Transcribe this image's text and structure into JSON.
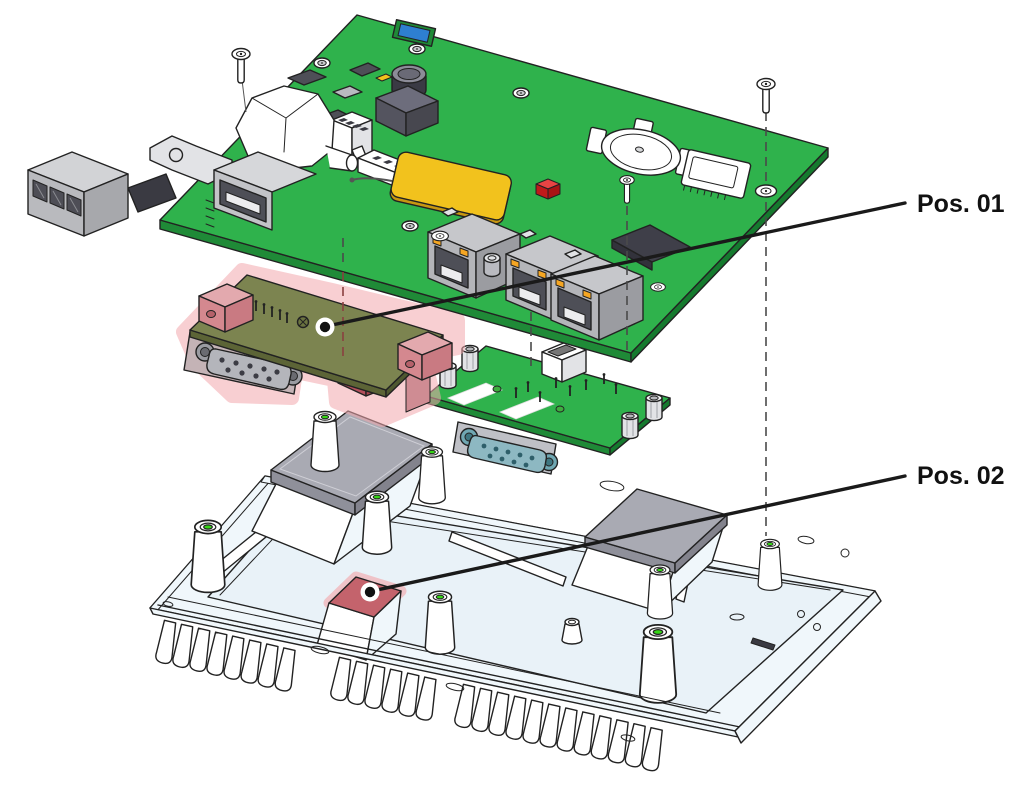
{
  "diagram": {
    "type": "exploded-assembly-technical-illustration",
    "background": "#ffffff",
    "callouts": [
      {
        "label": "Pos. 01",
        "target_part": "serial-interface-module"
      },
      {
        "label": "Pos. 02",
        "target_part": "thermal-pad-block"
      }
    ],
    "parts": [
      {
        "name": "mainboard-pcb"
      },
      {
        "name": "mounting-screw-left"
      },
      {
        "name": "mounting-screw-center"
      },
      {
        "name": "mounting-screw-right"
      },
      {
        "name": "serial-interface-module",
        "highlighted": true,
        "callout": "Pos. 01"
      },
      {
        "name": "io-adapter-board"
      },
      {
        "name": "heatsink-chassis"
      },
      {
        "name": "thermal-pad-left"
      },
      {
        "name": "thermal-pad-right"
      },
      {
        "name": "thermal-pad-block",
        "highlighted": true,
        "callout": "Pos. 02"
      },
      {
        "name": "db9-serial-connector-module"
      },
      {
        "name": "db9-serial-connector-adapter"
      },
      {
        "name": "ethernet-port-1"
      },
      {
        "name": "ethernet-port-2"
      },
      {
        "name": "ethernet-port-3"
      },
      {
        "name": "usb-port"
      },
      {
        "name": "terminal-block-connector"
      },
      {
        "name": "coin-cell-battery-holder"
      },
      {
        "name": "microsd-card-slot"
      },
      {
        "name": "antenna-pad"
      },
      {
        "name": "buzzer"
      },
      {
        "name": "standoff-posts"
      },
      {
        "name": "cooling-fins"
      }
    ],
    "colors": {
      "white": "#ffffff",
      "pcb_green": "#2fb24c",
      "pcb_green_dark": "#1f8a37",
      "module_olive": "#7c8450",
      "module_olive_edge": "#5c6436",
      "highlight_pink": "#f3a9ae",
      "highlight_red": "#c4636c",
      "chassis_fill": "#f0f7fb",
      "chassis_floor": "#e9f2f8",
      "pad_gray": "#a9aab3",
      "pad_gray_side": "#8f909a",
      "connector_gray": "#c6c7cb",
      "connector_gray_dark": "#9b9ca1",
      "connector_dark": "#4e4f57",
      "metal_light": "#e2e3e6",
      "teal": "#8db8c2",
      "yellow": "#f2c21d",
      "blue": "#2e7fd0",
      "red": "#e02222",
      "orange": "#f5a623",
      "thread_green": "#35d615",
      "line": "#222222",
      "dash": "#4a4a4a",
      "dash_red": "#8a4040",
      "leader": "#1a1a1a",
      "label_text": "#111111"
    }
  }
}
